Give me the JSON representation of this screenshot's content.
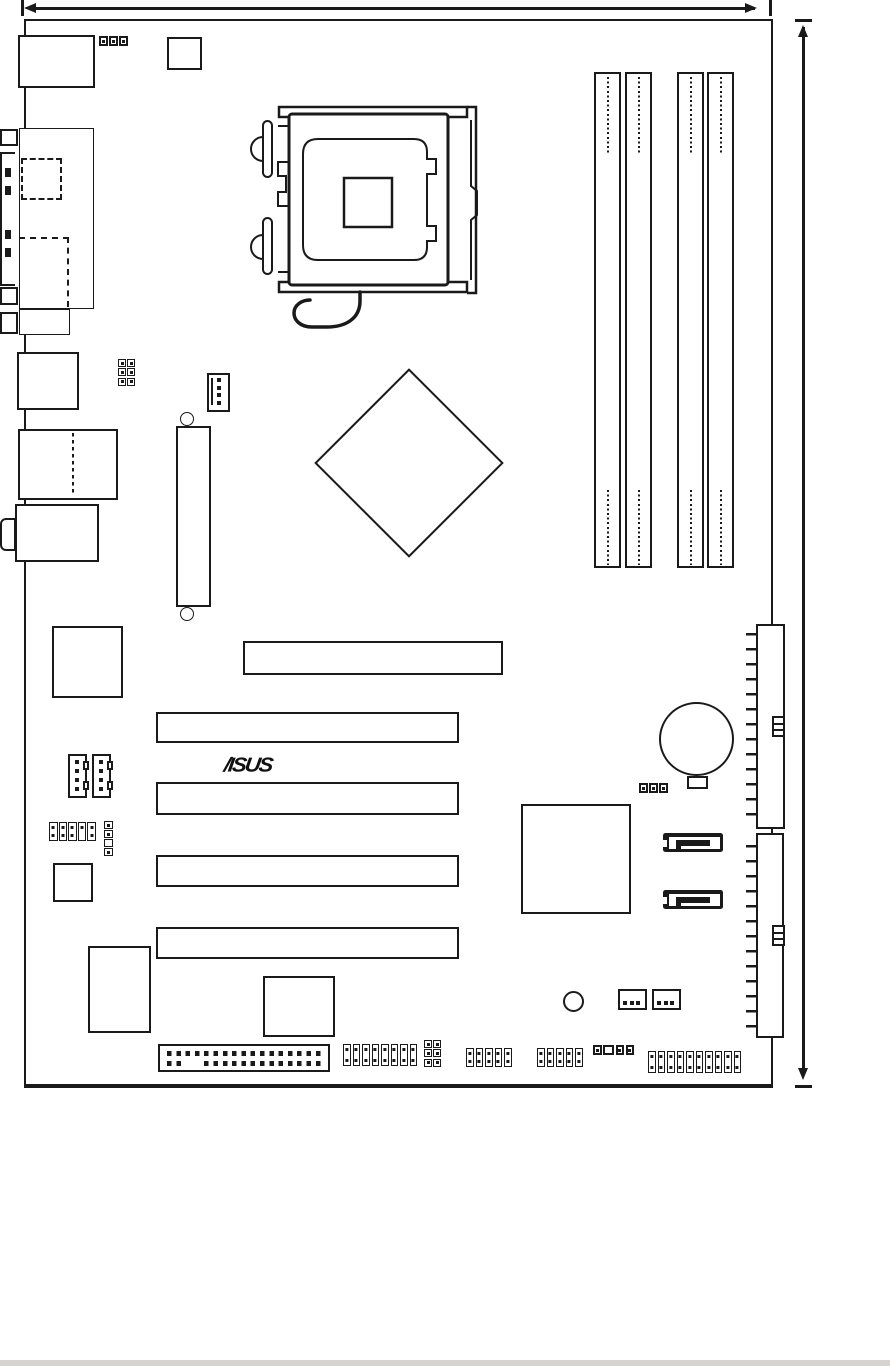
{
  "meta": {
    "figure": "motherboard layout diagram",
    "brand": "ASUS"
  },
  "colors": {
    "ink": "#1a1a1a",
    "paper": "#ffffff",
    "footer_bar": "#d7d3ce"
  },
  "logo": {
    "text": "ASUS",
    "display": "/ISUS"
  },
  "dimensions": {
    "width_arrow_position": "top edge",
    "height_arrow_position": "right edge"
  },
  "counts": {
    "dimm_slots": 4,
    "pci_slots": 4,
    "pcie_x16_slots": 1,
    "ide_connectors": 2,
    "sata_connectors": 2,
    "fan_connectors": 3,
    "cd_audio_connectors": 2,
    "rear_io_blocks": 5,
    "bottom_edge_headers": 7
  }
}
